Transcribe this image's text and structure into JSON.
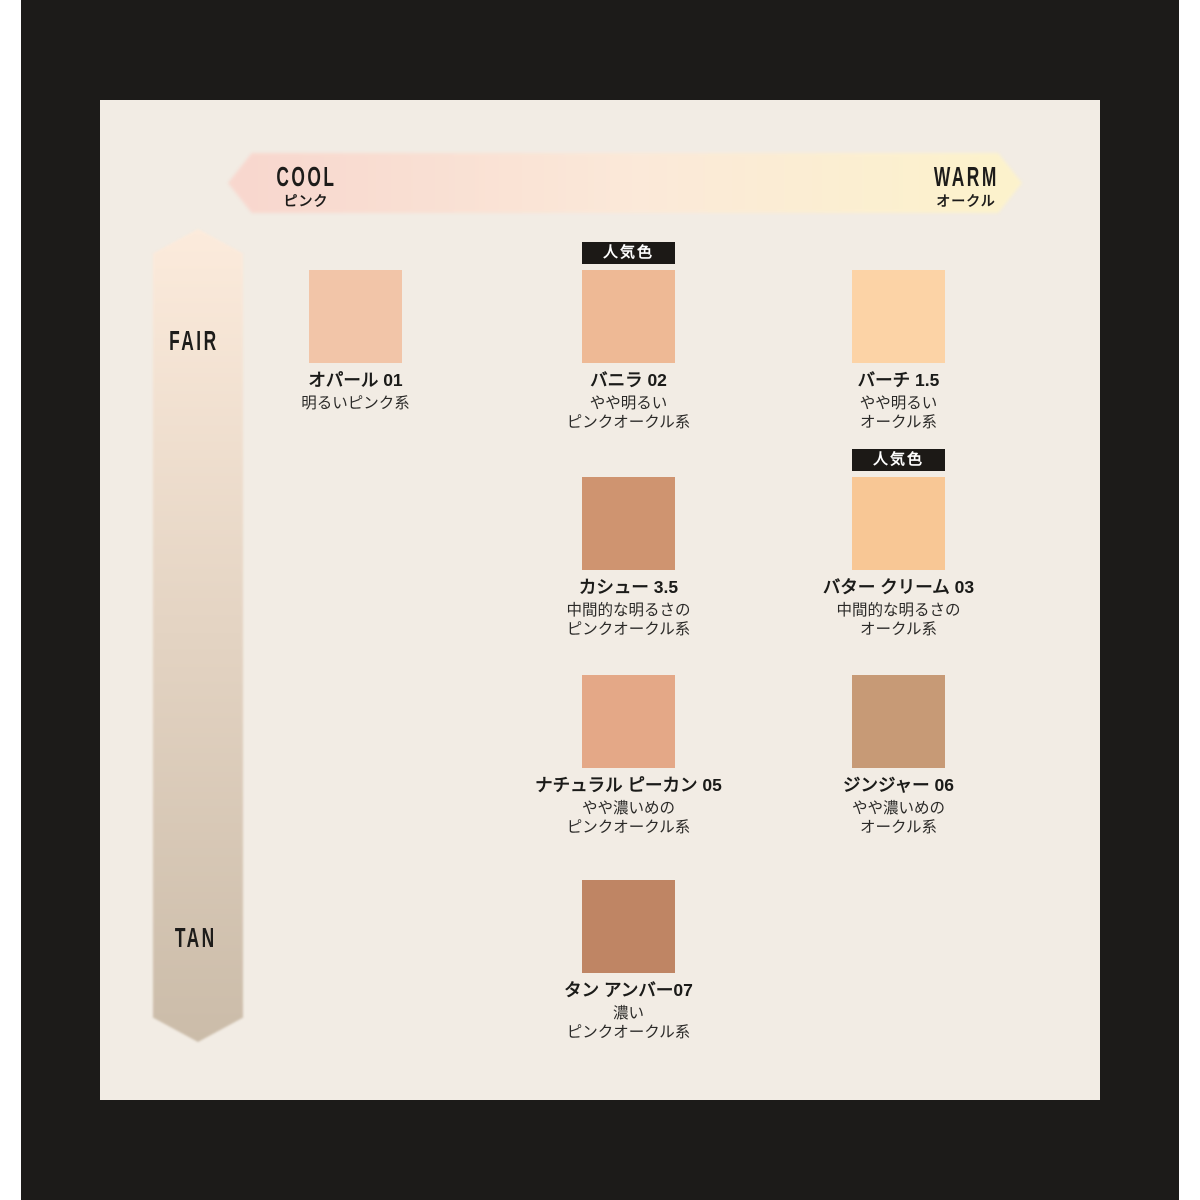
{
  "colors": {
    "canvas": "#ffffff",
    "frame": "#1c1b19",
    "panel": "#f2ece4",
    "badge_bg": "#1c1916",
    "badge_text": "#ffffff",
    "text": "#1d1c1a"
  },
  "badge_label": "人気色",
  "axes": {
    "horizontal": {
      "left_label": "COOL",
      "left_sublabel": "ピンク",
      "right_label": "WARM",
      "right_sublabel": "オークル",
      "gradient": [
        "#f8d7ce",
        "#fbe9d9",
        "#fcf2cc"
      ]
    },
    "vertical": {
      "top_label": "FAIR",
      "bottom_label": "TAN",
      "gradient": [
        "#fcebdc",
        "#cbbca9"
      ]
    }
  },
  "shades": [
    {
      "name": "オパール 01",
      "desc": [
        "明るいピンク系"
      ],
      "color": "#f2c5a8",
      "popular": false,
      "tone_column": "pink",
      "depth_row": "fair"
    },
    {
      "name": "バニラ 02",
      "desc": [
        "やや明るい",
        "ピンクオークル系"
      ],
      "color": "#eeb995",
      "popular": true,
      "tone_column": "pink-ochre",
      "depth_row": "fair"
    },
    {
      "name": "バーチ 1.5",
      "desc": [
        "やや明るい",
        "オークル系"
      ],
      "color": "#fcd3a6",
      "popular": false,
      "tone_column": "ochre",
      "depth_row": "fair"
    },
    {
      "name": "カシュー 3.5",
      "desc": [
        "中間的な明るさの",
        "ピンクオークル系"
      ],
      "color": "#cf9470",
      "popular": false,
      "tone_column": "pink-ochre",
      "depth_row": "medium"
    },
    {
      "name": "バター クリーム 03",
      "desc": [
        "中間的な明るさの",
        "オークル系"
      ],
      "color": "#f8c795",
      "popular": true,
      "tone_column": "ochre",
      "depth_row": "medium"
    },
    {
      "name": "ナチュラル ピーカン 05",
      "desc": [
        "やや濃いめの",
        "ピンクオークル系"
      ],
      "color": "#e4a887",
      "popular": false,
      "tone_column": "pink-ochre",
      "depth_row": "deep"
    },
    {
      "name": "ジンジャー 06",
      "desc": [
        "やや濃いめの",
        "オークル系"
      ],
      "color": "#c79a76",
      "popular": false,
      "tone_column": "ochre",
      "depth_row": "deep"
    },
    {
      "name": "タン アンバー07",
      "desc": [
        "濃い",
        "ピンクオークル系"
      ],
      "color": "#bf8564",
      "popular": false,
      "tone_column": "pink-ochre",
      "depth_row": "tan"
    }
  ]
}
